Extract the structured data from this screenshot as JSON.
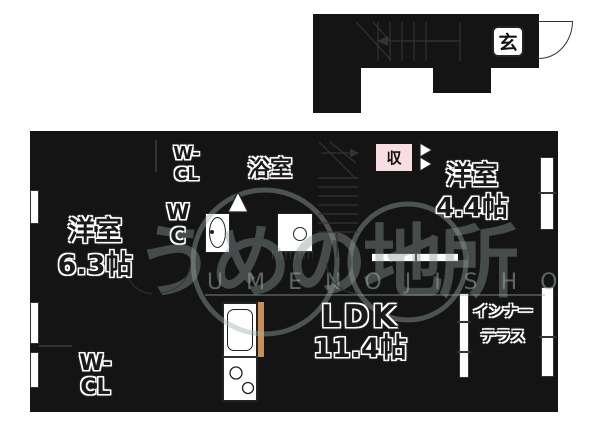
{
  "colors": {
    "wall": "#141414",
    "room_orange": "#f6c98c",
    "room_yellow": "#f8f6a3",
    "room_pink": "#f8d8dc",
    "room_blue": "#c9ebf4",
    "floor_cream": "#fdfce9",
    "entrance_gray": "#d8d8d8",
    "step_pink": "#f8dde2"
  },
  "upper_floor": {
    "entrance_label": "玄"
  },
  "rooms": {
    "bedroom_63": {
      "name": "洋室",
      "size": "6.3帖"
    },
    "bedroom_44": {
      "name": "洋室",
      "size": "4.4帖"
    },
    "ldk": {
      "name": "LDK",
      "size": "11.4帖"
    },
    "bathroom": {
      "name": "浴室"
    },
    "wc": {
      "line1": "W",
      "line2": "C"
    },
    "walkin_closet_upper": {
      "line1": "W-",
      "line2": "CL"
    },
    "walkin_closet_lower": {
      "line1": "W-",
      "line2": "CL"
    },
    "storage": {
      "name": "収"
    },
    "inner_terrace": {
      "line1": "インナー",
      "line2": "テラス"
    }
  },
  "watermark": {
    "logo_text": "うめの地所",
    "romaji": "U M E N O  J I S H O"
  }
}
